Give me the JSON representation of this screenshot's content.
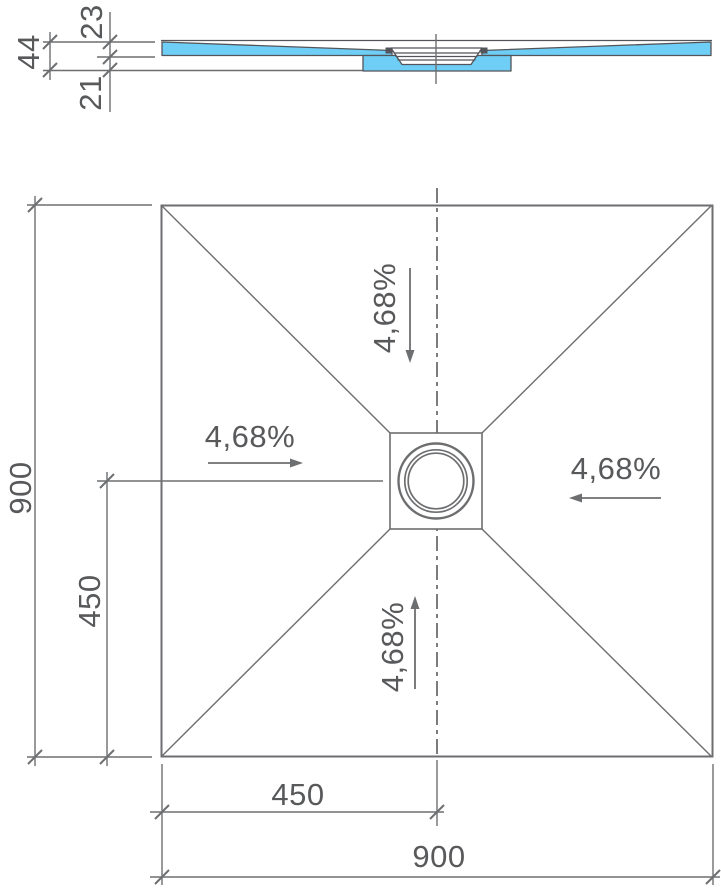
{
  "colors": {
    "surface_fill": "#6ecef5",
    "line": "#6d6e70",
    "text": "#58595b"
  },
  "section_view": {
    "dim_tray_thickness": "23",
    "dim_total_thickness": "44",
    "dim_base_thickness": "21"
  },
  "plan_view": {
    "slope_top": "4,68%",
    "slope_left": "4,68%",
    "slope_right": "4,68%",
    "slope_bottom": "4,68%",
    "dim_side_left": "900",
    "dim_half_left": "450",
    "dim_half_bottom": "450",
    "dim_side_bottom": "900"
  }
}
